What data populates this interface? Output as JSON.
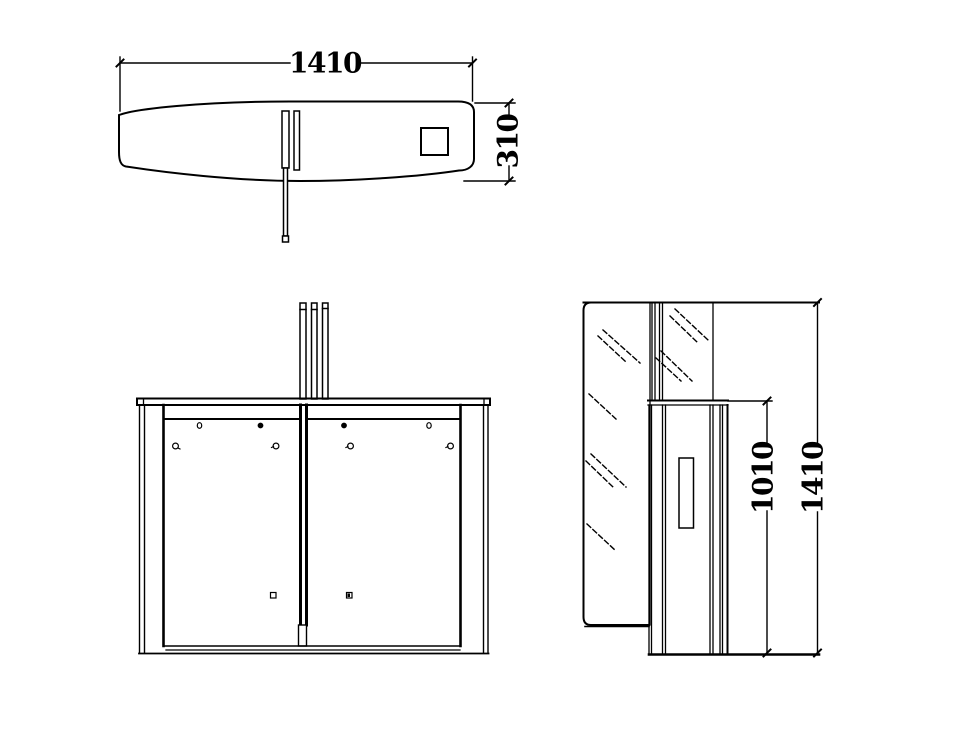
{
  "colors": {
    "background": "#ffffff",
    "line": "#000000"
  },
  "dims": {
    "top_width": "1410",
    "top_depth": "310",
    "side_inner_height": "1010",
    "side_total_height": "1410"
  }
}
